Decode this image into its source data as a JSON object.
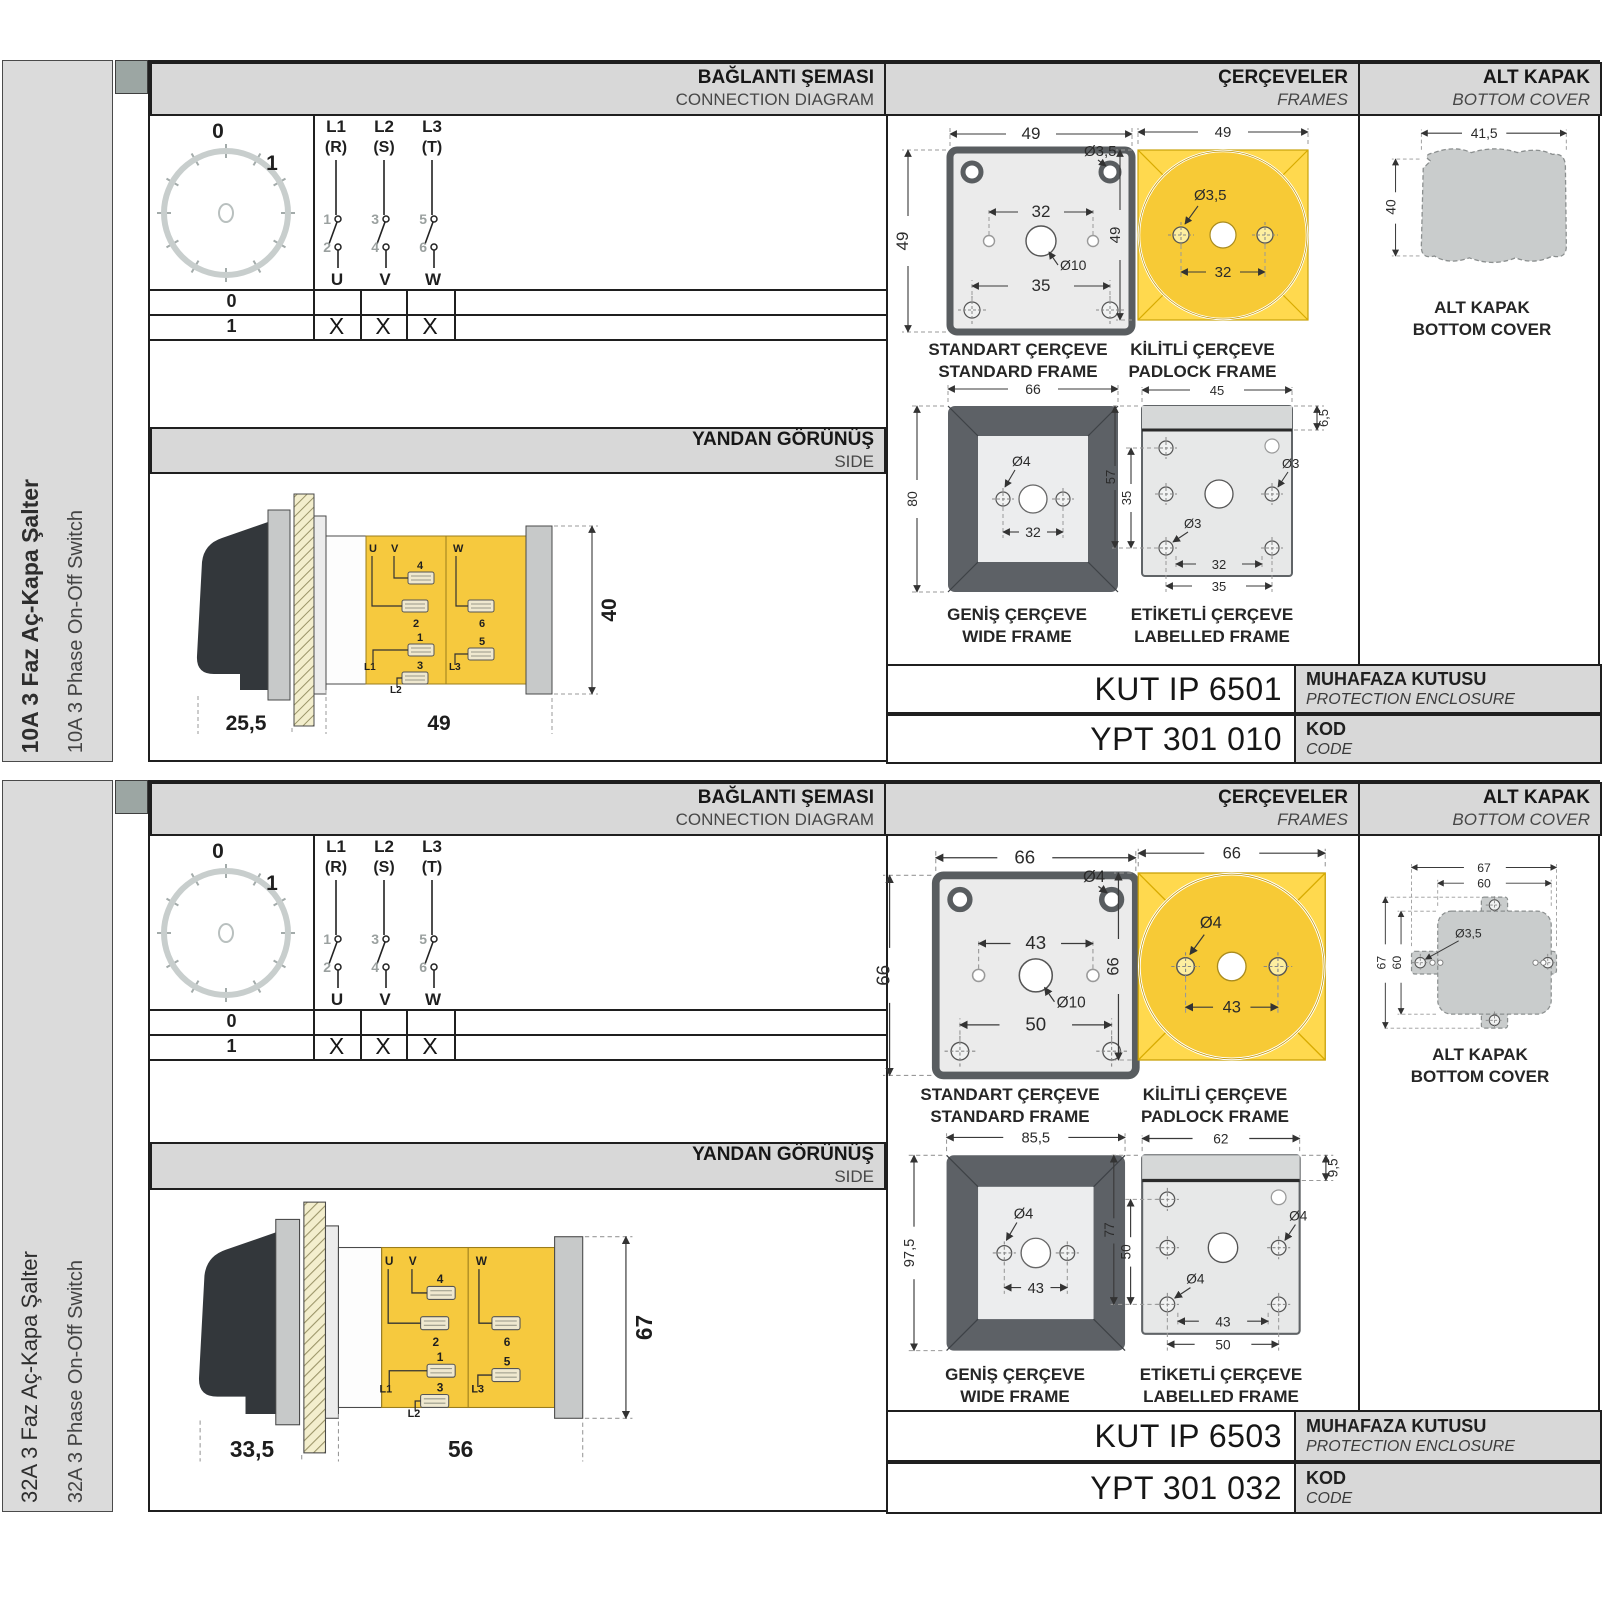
{
  "headers": {
    "connection": {
      "tr": "BAĞLANTI ŞEMASI",
      "en": "CONNECTION DIAGRAM"
    },
    "frames": {
      "tr": "ÇERÇEVELER",
      "en": "FRAMES"
    },
    "bottom_cover": {
      "tr": "ALT KAPAK",
      "en": "BOTTOM COVER"
    },
    "side_view": {
      "tr": "YANDAN GÖRÜNÜŞ",
      "en": "SIDE"
    }
  },
  "captions": {
    "standard_frame": {
      "tr": "STANDART ÇERÇEVE",
      "en": "STANDARD FRAME"
    },
    "padlock_frame": {
      "tr": "KİLİTLİ ÇERÇEVE",
      "en": "PADLOCK FRAME"
    },
    "wide_frame": {
      "tr": "GENİŞ ÇERÇEVE",
      "en": "WIDE FRAME"
    },
    "labelled_frame": {
      "tr": "ETİKETLİ ÇERÇEVE",
      "en": "LABELLED FRAME"
    },
    "bottom_cover": {
      "tr": "ALT KAPAK",
      "en": "BOTTOM COVER"
    },
    "enclosure": {
      "tr": "MUHAFAZA KUTUSU",
      "en": "PROTECTION ENCLOSURE"
    },
    "code": {
      "tr": "KOD",
      "en": "CODE"
    }
  },
  "connection_diagram": {
    "dial_positions": [
      "0",
      "1"
    ],
    "phases": [
      {
        "line": "L1",
        "phase": "(R)",
        "contact_top": "1",
        "contact_bottom": "2",
        "terminal": "U"
      },
      {
        "line": "L2",
        "phase": "(S)",
        "contact_top": "3",
        "contact_bottom": "4",
        "terminal": "V"
      },
      {
        "line": "L3",
        "phase": "(T)",
        "contact_top": "5",
        "contact_bottom": "6",
        "terminal": "W"
      }
    ],
    "table": [
      {
        "position": "0",
        "marks": [
          "",
          "",
          ""
        ]
      },
      {
        "position": "1",
        "marks": [
          "X",
          "X",
          "X"
        ]
      }
    ]
  },
  "side_terminals": {
    "u": "U",
    "v": "V",
    "w": "W",
    "t1": "1",
    "t2": "2",
    "t3": "3",
    "t4": "4",
    "t5": "5",
    "t6": "6",
    "l1": "L1",
    "l2": "L2",
    "l3": "L3"
  },
  "products": [
    {
      "name_tr": "10A 3 Faz Aç-Kapa Şalter",
      "name_en": "10A 3 Phase On-Off Switch",
      "side_view": {
        "knob_depth": "25,5",
        "body_depth": "49",
        "height": "40"
      },
      "standard_frame": {
        "width": "49",
        "height": "49",
        "hole_span": "32",
        "screw_span": "35",
        "screw_dia": "Ø3,5",
        "shaft_dia": "Ø10"
      },
      "padlock_frame": {
        "width": "49",
        "height": "49",
        "screw_dia": "Ø3,5",
        "screw_span": "32"
      },
      "wide_frame": {
        "width": "66",
        "height": "80",
        "screw_dia": "Ø4",
        "screw_span": "32"
      },
      "labelled_frame": {
        "width": "45",
        "label_height": "6,5",
        "height": "57",
        "hole_height": "35",
        "hole_dia_mid": "Ø3",
        "hole_dia_low": "Ø3",
        "span_inner": "32",
        "span_outer": "35"
      },
      "bottom_cover": {
        "width": "41,5",
        "height": "40"
      },
      "enclosure_code": "KUT IP 6501",
      "order_code": "YPT 301 010"
    },
    {
      "name_tr": "32A 3 Faz Aç-Kapa Şalter",
      "name_en": "32A 3 Phase On-Off Switch",
      "side_view": {
        "knob_depth": "33,5",
        "body_depth": "56",
        "height": "67"
      },
      "standard_frame": {
        "width": "66",
        "height": "66",
        "hole_span": "43",
        "screw_span": "50",
        "screw_dia": "Ø4",
        "shaft_dia": "Ø10"
      },
      "padlock_frame": {
        "width": "66",
        "height": "66",
        "screw_dia": "Ø4",
        "screw_span": "43"
      },
      "wide_frame": {
        "width": "85,5",
        "height": "97,5",
        "screw_dia": "Ø4",
        "screw_span": "43"
      },
      "labelled_frame": {
        "width": "62",
        "label_height": "9,5",
        "height": "77",
        "hole_height": "50",
        "hole_dia_mid": "Ø4",
        "hole_dia_low": "Ø4",
        "span_inner": "43",
        "span_outer": "50"
      },
      "bottom_cover": {
        "width_outer": "67",
        "width_inner": "60",
        "height_outer": "67",
        "height_inner": "60",
        "hole_dia": "Ø3,5"
      },
      "enclosure_code": "KUT IP 6503",
      "order_code": "YPT 301 032"
    }
  ],
  "colors": {
    "accent_yellow": "#F6C93E",
    "panel_gray": "#D8D8D8",
    "line_dark": "#1F1F1F"
  }
}
